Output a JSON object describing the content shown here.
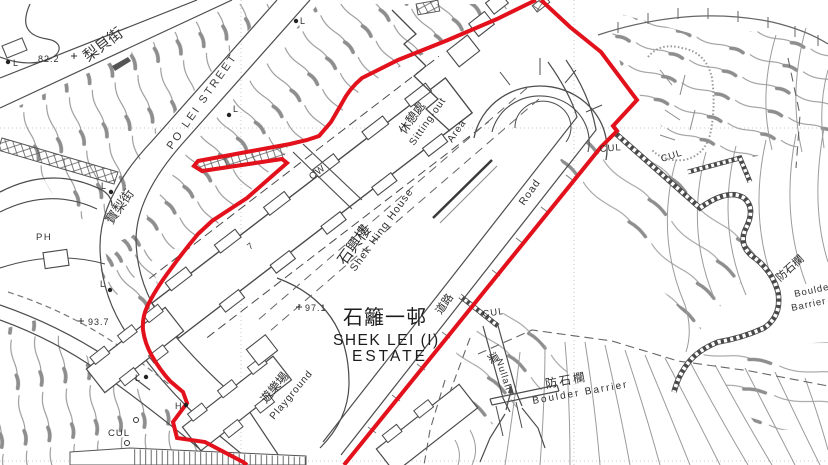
{
  "map": {
    "streets": {
      "lei_pui_cn": "梨貝街",
      "po_lei_en": "PO LEI STREET",
      "po_lei_cn": "寶梨街"
    },
    "estate": {
      "name_cn": "石籬一邨",
      "name_en_line1": "SHEK LEI (I)",
      "name_en_line2": "ESTATE"
    },
    "buildings": {
      "shek_hing_cn": "石興樓",
      "shek_hing_en": "Shek Hing House",
      "block_no": "7",
      "ph": "PH",
      "cw": "CW"
    },
    "areas": {
      "sitting_out_cn": "休憩處",
      "sitting_out_en_line1": "Sitting-out",
      "sitting_out_en_line2": "Area",
      "playground_cn": "遊樂場",
      "playground_en": "Playground"
    },
    "road": {
      "cn": "道路",
      "en": "Road"
    },
    "nullah": {
      "cn": "渠",
      "en": "Nullah"
    },
    "boulder_barrier": {
      "cn": "防石欄",
      "en": "Boulder Barrier",
      "en_word1": "Boulder",
      "en_word2": "Barrier"
    },
    "annotations": {
      "cul": "CUL",
      "l_marker": "L",
      "h_marker": "H"
    },
    "spot_heights": {
      "h_82": "82.2",
      "h_93": "93.7",
      "h_97": "97.1"
    },
    "colors": {
      "boundary_red": "#e2111b",
      "linework_gray": "#4d4d4d",
      "hachure_gray": "#949494",
      "contour_gray": "#9b9b9b"
    }
  }
}
